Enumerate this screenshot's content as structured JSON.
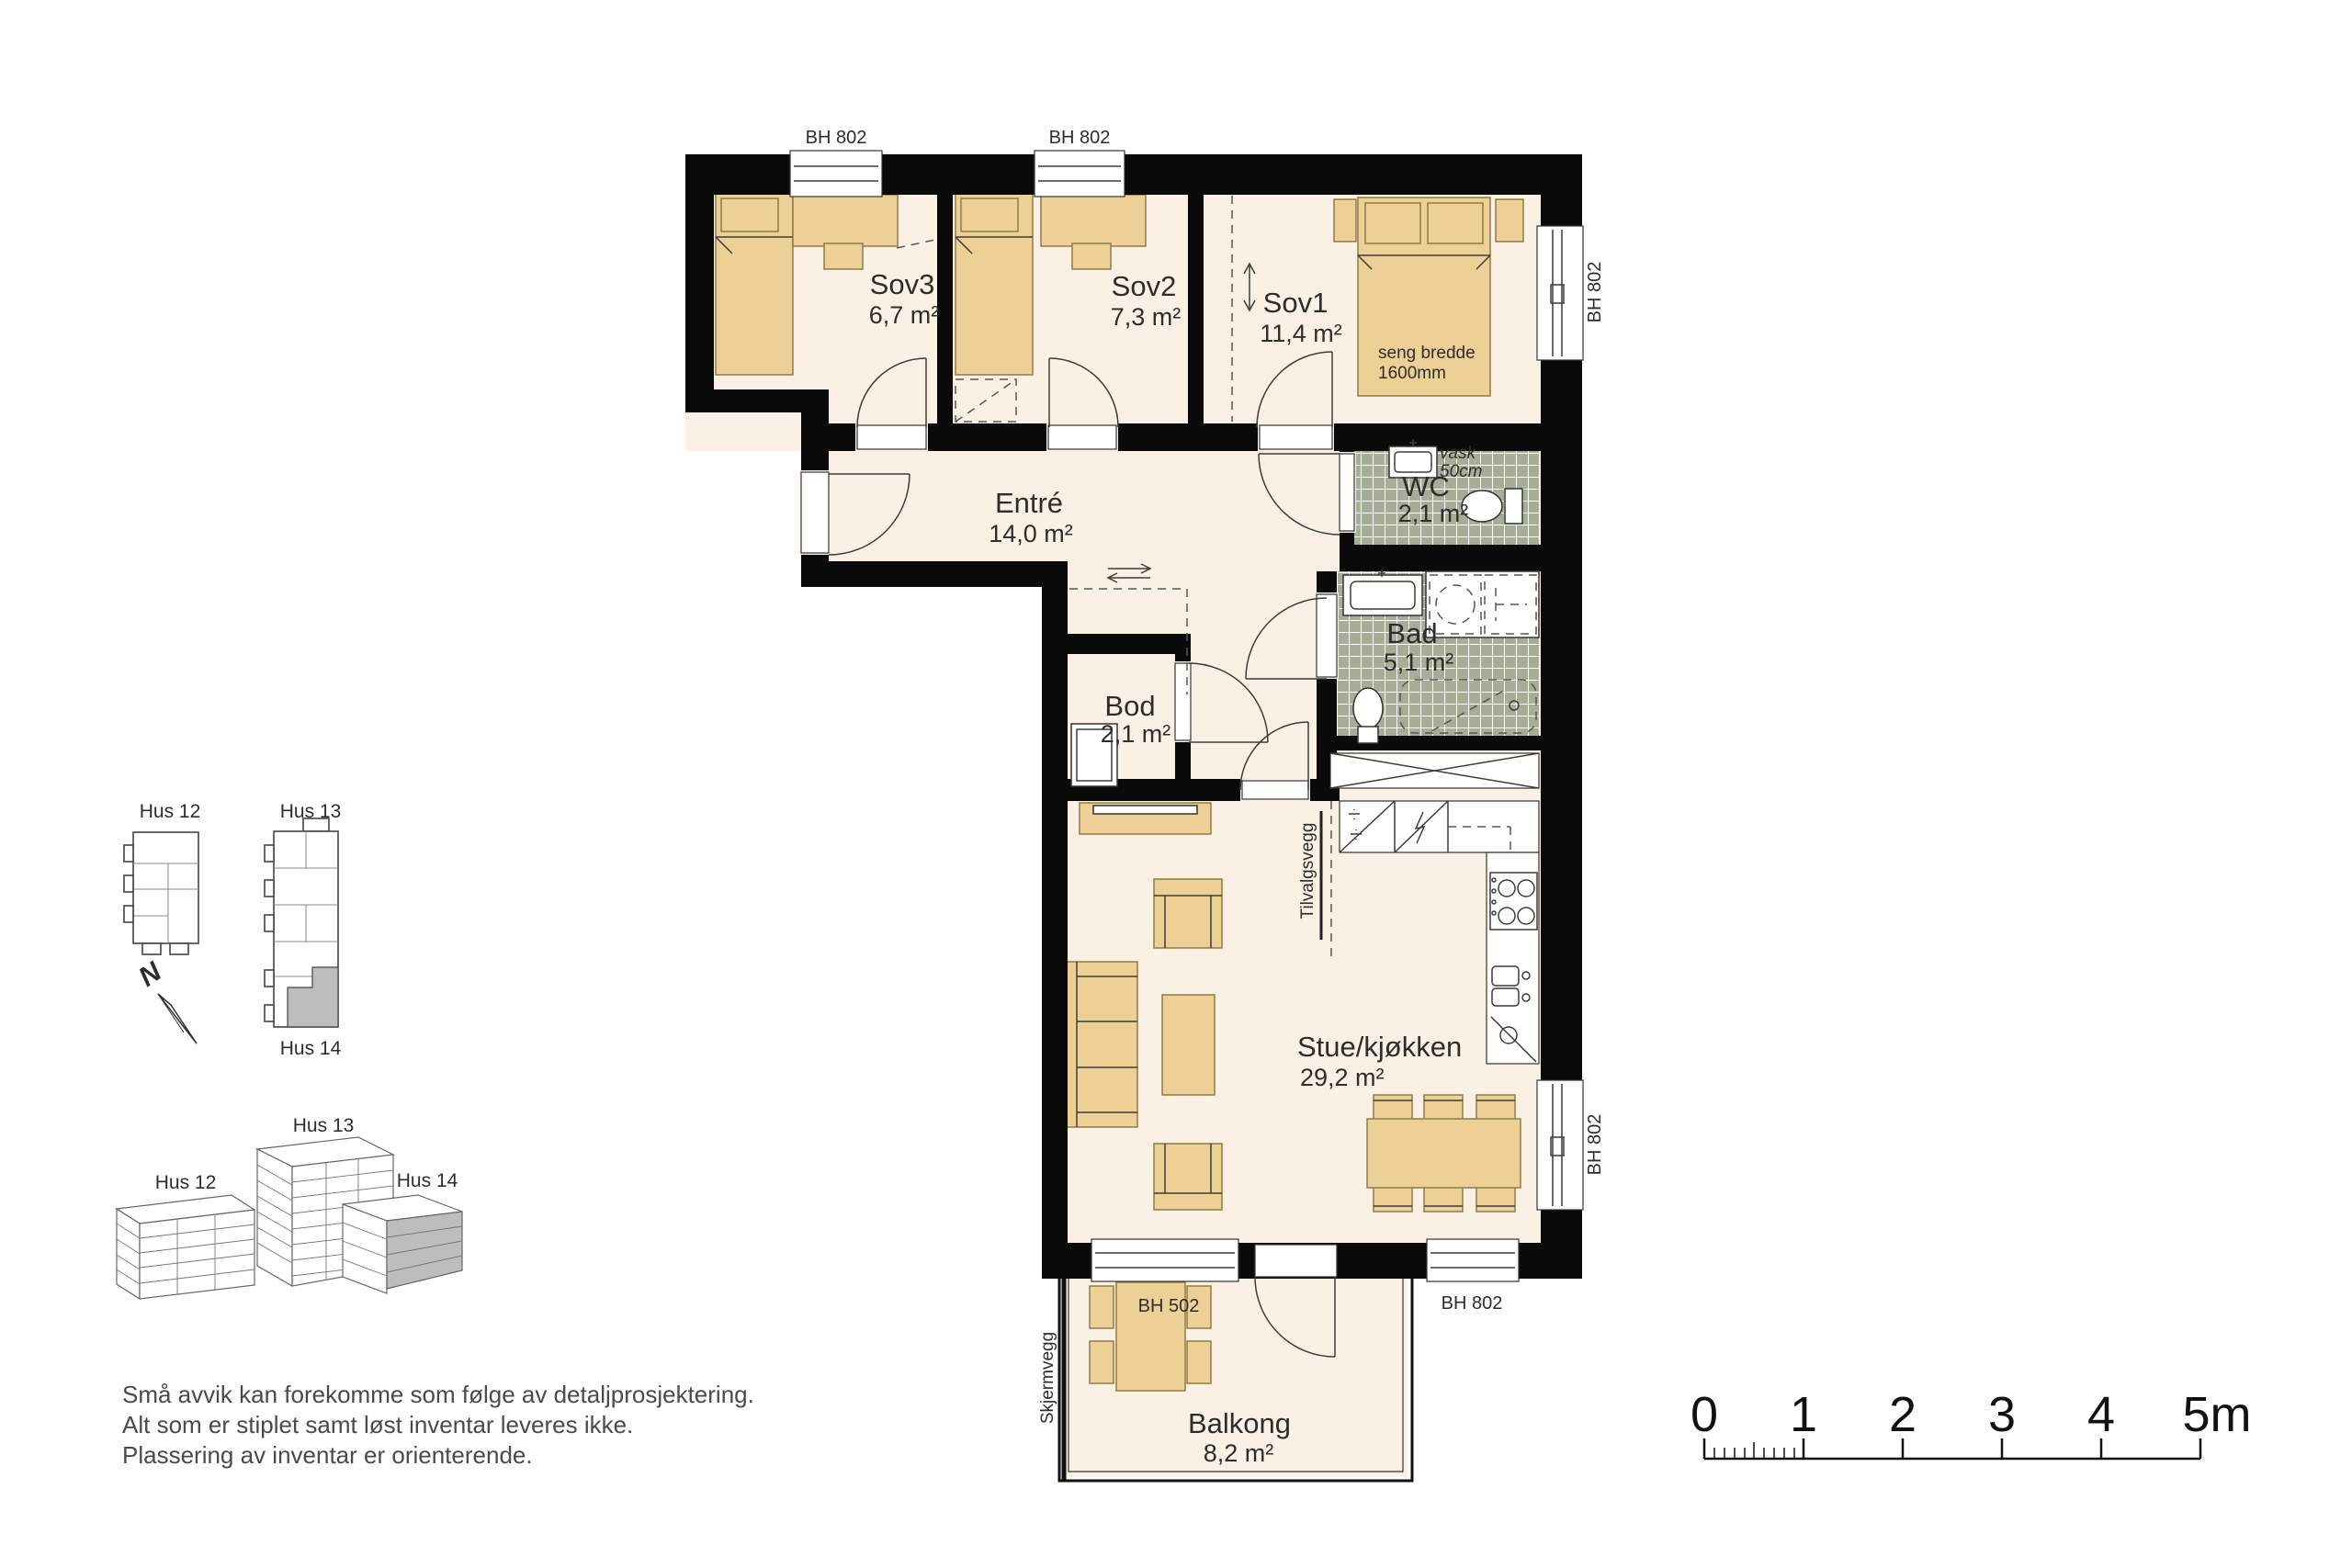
{
  "colors": {
    "wall": "#0a0a0a",
    "floor": "#faf1e4",
    "furniture": "#edd095",
    "tile": "#a6ae97",
    "highlight": "#bdbdbd"
  },
  "plan": {
    "rooms": [
      {
        "id": "sov3",
        "name": "Sov3",
        "area": "6,7 m²"
      },
      {
        "id": "sov2",
        "name": "Sov2",
        "area": "7,3 m²"
      },
      {
        "id": "sov1",
        "name": "Sov1",
        "area": "11,4 m²"
      },
      {
        "id": "entre",
        "name": "Entré",
        "area": "14,0 m²"
      },
      {
        "id": "wc",
        "name": "WC",
        "area": "2,1 m²"
      },
      {
        "id": "bad",
        "name": "Bad",
        "area": "5,1 m²"
      },
      {
        "id": "bod",
        "name": "Bod",
        "area": "2,1 m²"
      },
      {
        "id": "stue",
        "name": "Stue/kjøkken",
        "area": "29,2 m²"
      },
      {
        "id": "balkong",
        "name": "Balkong",
        "area": "8,2 m²"
      }
    ],
    "annotations": {
      "bh802_top_sov3": "BH 802",
      "bh802_top_sov2": "BH 802",
      "bh802_right_sov1": "BH 802",
      "bh802_right_stue": "BH 802",
      "bh802_bottom_stue": "BH 802",
      "bh502_balcony": "BH 502",
      "seng_bredde": "seng bredde",
      "seng_bredde_value": "1600mm",
      "vask": "vask",
      "vask_size": "50cm",
      "tilvalgsvegg": "Tilvalgsvegg",
      "skjermvegg": "Skjermvegg"
    }
  },
  "site_plan": {
    "hus12": "Hus 12",
    "hus13": "Hus 13",
    "hus14": "Hus 14",
    "north_label": "N"
  },
  "overview_3d": {
    "hus12": "Hus 12",
    "hus13": "Hus 13",
    "hus14": "Hus 14"
  },
  "disclaimer": [
    "Små avvik kan forekomme som følge av detaljprosjektering.",
    "Alt som er stiplet samt løst inventar leveres ikke.",
    "Plassering av inventar er orienterende."
  ],
  "scale_bar": {
    "labels": [
      "0",
      "1",
      "2",
      "3",
      "4",
      "5m"
    ]
  }
}
